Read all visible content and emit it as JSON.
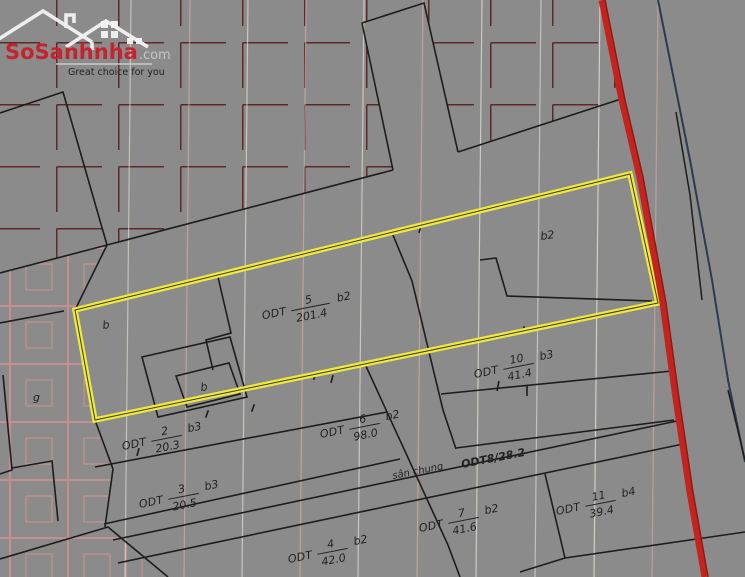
{
  "logo": {
    "brand_main": "SoSanhnha",
    "brand_suffix": ".com",
    "tagline": "Great choice for you"
  },
  "map": {
    "parcels": [
      {
        "prefix": "ODT",
        "number": "5",
        "area": "201.4",
        "zone": "b2"
      },
      {
        "prefix": "ODT",
        "number": "10",
        "area": "41.4",
        "zone": "b3"
      },
      {
        "prefix": "ODT",
        "number": "2",
        "area": "20.3",
        "zone": "b3"
      },
      {
        "prefix": "ODT",
        "number": "3",
        "area": "20.5",
        "zone": "b3"
      },
      {
        "prefix": "ODT",
        "number": "6",
        "area": "98.0",
        "zone": "b2"
      },
      {
        "prefix": "ODT",
        "number": "4",
        "area": "42.0",
        "zone": "b2"
      },
      {
        "prefix": "ODT",
        "number": "7",
        "area": "41.6",
        "zone": "b2"
      },
      {
        "prefix": "ODT",
        "number": "11",
        "area": "39.4",
        "zone": "b4"
      }
    ],
    "annotations": {
      "common_yard": "sân chung",
      "yard_code": "ODT8/28.2",
      "zone_b2": "b2",
      "zone_b_left": "b",
      "zone_b_small": "b",
      "zone_g": "g"
    },
    "colors": {
      "background_gray": "#8b8b8b",
      "highlight_yellow": "#efe83e",
      "road_red": "#c4241e",
      "boundary_black": "#1d1d1d",
      "grid_red": "#5c2a28",
      "pattern_pink": "#d99090",
      "logo_red": "#c5242e"
    }
  }
}
